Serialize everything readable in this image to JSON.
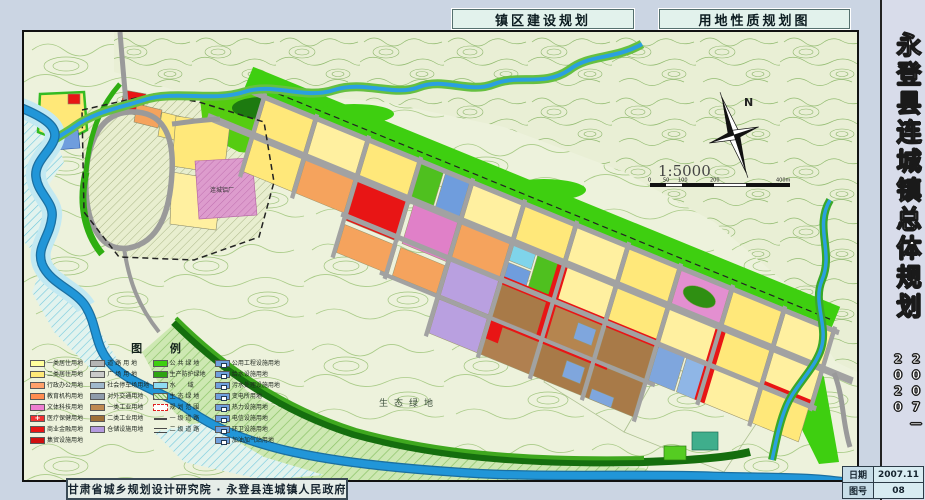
{
  "titles": {
    "left": "镇区建设规划",
    "right": "用地性质规划图"
  },
  "sidebar": {
    "title": "永登县连城镇总体规划",
    "years": "2007—2020"
  },
  "footer": {
    "credit": "甘肃省城乡规划设计研究院 · 永登县连城镇人民政府"
  },
  "info_table": {
    "date_label": "日期",
    "date_value": "2007.11",
    "sheet_label": "图号",
    "sheet_value": "08"
  },
  "map": {
    "north_label": "N",
    "scale_text": "1:5000",
    "scale_ticks": [
      "0",
      "50",
      "100",
      "200",
      "400m"
    ],
    "labels": {
      "plant": "连城铝厂",
      "eco": "生态绿地"
    },
    "colors": {
      "background": "#edf2dc",
      "contour": "#a9cb87",
      "river": "#2196d8",
      "green_belt": "#3ecf10",
      "road": "#a2a2a2",
      "residential": "#ffe87a",
      "commercial": "#e81515",
      "industrial": "#a87a48",
      "storage": "#b9a0e0",
      "utility": "#6f9ddd",
      "education": "#f5a35d",
      "culture": "#e38fd0"
    }
  },
  "legend": {
    "title": "图  例",
    "col1": [
      {
        "label": "一类居住用地",
        "color": "#ffff9c"
      },
      {
        "label": "二类居住用地",
        "color": "#ffe978"
      },
      {
        "label": "行政办公用地",
        "color": "#ffa06a"
      },
      {
        "label": "教育机构用地",
        "color": "#ff8c50"
      },
      {
        "label": "文体科技用地",
        "color": "#ee7fd0"
      },
      {
        "label": "医疗保健用地",
        "color": "#f03030"
      },
      {
        "label": "商业金融用地",
        "color": "#e81515"
      },
      {
        "label": "集贸设施用地",
        "color": "#d01010"
      }
    ],
    "col2": [
      {
        "label": "道 路 用 地",
        "color": "#b4b4b4"
      },
      {
        "label": "广 场 用 地",
        "color": "#cacaca"
      },
      {
        "label": "社会停车场用地",
        "color": "#9fb8cc"
      },
      {
        "label": "对外交通用地",
        "color": "#8f9cab"
      },
      {
        "label": "一类工业用地",
        "color": "#c08a52"
      },
      {
        "label": "二类工业用地",
        "color": "#9e7038"
      },
      {
        "label": "仓储设施用地",
        "color": "#b49ade"
      }
    ],
    "col3": [
      {
        "label": "公 共 绿 地",
        "color": "#3ed00e"
      },
      {
        "label": "生产防护绿地",
        "color": "#2fa412"
      },
      {
        "label": "水　　域",
        "color": "#8fdcf2"
      },
      {
        "label": "生 态 绿 地",
        "color": "#d8ecc4"
      },
      {
        "label": "规 划 范 围",
        "color": "#ffffff"
      },
      {
        "label": "一 级 道 路",
        "color": "#ffffff"
      },
      {
        "label": "二 级 道 路",
        "color": "#ffffff"
      }
    ],
    "col4": [
      {
        "label": "公用工程设施用地",
        "color": "#6f9fdd"
      },
      {
        "label": "给水设施用地",
        "color": "#6f9fdd"
      },
      {
        "label": "污水处理设施用地",
        "color": "#6f9fdd"
      },
      {
        "label": "变电所用地",
        "color": "#6f9fdd"
      },
      {
        "label": "热力设施用地",
        "color": "#6f9fdd"
      },
      {
        "label": "电信设施用地",
        "color": "#6f9fdd"
      },
      {
        "label": "环卫设施用地",
        "color": "#6f9fdd"
      },
      {
        "label": "加油加气站用地",
        "color": "#6f9fdd"
      }
    ]
  }
}
